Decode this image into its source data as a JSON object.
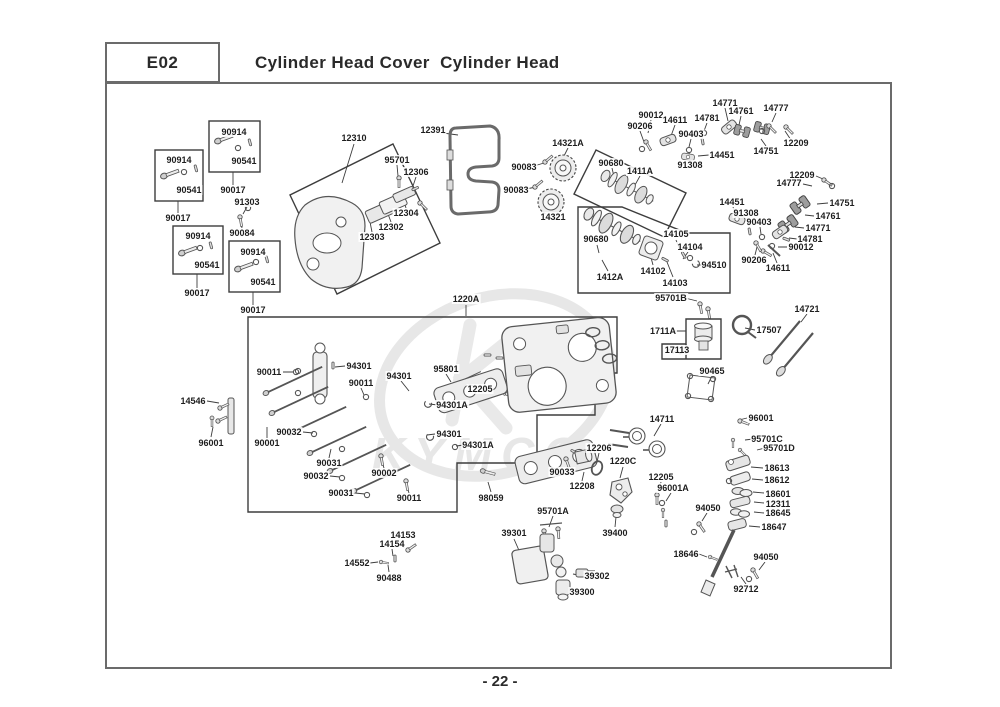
{
  "header": {
    "code": "E02",
    "title": "Cylinder Head Cover  Cylinder Head"
  },
  "footer": {
    "page_number": "- 22 -"
  },
  "watermark": {
    "text": "KYMCO"
  },
  "diagram": {
    "labels": [
      {
        "text": "90914",
        "x": 234,
        "y": 132
      },
      {
        "text": "90541",
        "x": 244,
        "y": 161
      },
      {
        "text": "90017",
        "x": 233,
        "y": 190
      },
      {
        "text": "90914",
        "x": 179,
        "y": 160
      },
      {
        "text": "90541",
        "x": 189,
        "y": 190
      },
      {
        "text": "90017",
        "x": 178,
        "y": 218
      },
      {
        "text": "91303",
        "x": 247,
        "y": 202
      },
      {
        "text": "90084",
        "x": 242,
        "y": 233
      },
      {
        "text": "90914",
        "x": 198,
        "y": 236
      },
      {
        "text": "90541",
        "x": 207,
        "y": 265
      },
      {
        "text": "90017",
        "x": 197,
        "y": 293
      },
      {
        "text": "90914",
        "x": 253,
        "y": 252
      },
      {
        "text": "90541",
        "x": 263,
        "y": 282
      },
      {
        "text": "90017",
        "x": 253,
        "y": 310
      },
      {
        "text": "12310",
        "x": 354,
        "y": 138
      },
      {
        "text": "95701",
        "x": 397,
        "y": 160
      },
      {
        "text": "12306",
        "x": 416,
        "y": 172
      },
      {
        "text": "12304",
        "x": 406,
        "y": 213
      },
      {
        "text": "12302",
        "x": 391,
        "y": 227
      },
      {
        "text": "12303",
        "x": 372,
        "y": 237
      },
      {
        "text": "12391",
        "x": 433,
        "y": 130
      },
      {
        "text": "14321A",
        "x": 568,
        "y": 143
      },
      {
        "text": "90083",
        "x": 524,
        "y": 167
      },
      {
        "text": "90083",
        "x": 516,
        "y": 190
      },
      {
        "text": "14321",
        "x": 553,
        "y": 217
      },
      {
        "text": "90012",
        "x": 651,
        "y": 115
      },
      {
        "text": "90206",
        "x": 640,
        "y": 126
      },
      {
        "text": "14611",
        "x": 675,
        "y": 120
      },
      {
        "text": "14781",
        "x": 707,
        "y": 118
      },
      {
        "text": "14771",
        "x": 725,
        "y": 103
      },
      {
        "text": "14761",
        "x": 741,
        "y": 111
      },
      {
        "text": "14777",
        "x": 776,
        "y": 108
      },
      {
        "text": "12209",
        "x": 796,
        "y": 143
      },
      {
        "text": "14751",
        "x": 766,
        "y": 151
      },
      {
        "text": "90403",
        "x": 691,
        "y": 134
      },
      {
        "text": "14451",
        "x": 722,
        "y": 155
      },
      {
        "text": "91308",
        "x": 690,
        "y": 165
      },
      {
        "text": "90680",
        "x": 611,
        "y": 163
      },
      {
        "text": "1411A",
        "x": 640,
        "y": 171
      },
      {
        "text": "12209",
        "x": 802,
        "y": 175
      },
      {
        "text": "14777",
        "x": 789,
        "y": 183
      },
      {
        "text": "14751",
        "x": 842,
        "y": 203
      },
      {
        "text": "14761",
        "x": 828,
        "y": 216
      },
      {
        "text": "14771",
        "x": 818,
        "y": 228
      },
      {
        "text": "14781",
        "x": 810,
        "y": 239
      },
      {
        "text": "90012",
        "x": 801,
        "y": 247
      },
      {
        "text": "14451",
        "x": 732,
        "y": 202
      },
      {
        "text": "91308",
        "x": 746,
        "y": 213
      },
      {
        "text": "90403",
        "x": 759,
        "y": 222
      },
      {
        "text": "90206",
        "x": 754,
        "y": 260
      },
      {
        "text": "14611",
        "x": 778,
        "y": 268
      },
      {
        "text": "90680",
        "x": 596,
        "y": 239
      },
      {
        "text": "1412A",
        "x": 610,
        "y": 277
      },
      {
        "text": "14102",
        "x": 653,
        "y": 271
      },
      {
        "text": "14103",
        "x": 675,
        "y": 283
      },
      {
        "text": "14104",
        "x": 690,
        "y": 247
      },
      {
        "text": "14105",
        "x": 676,
        "y": 234
      },
      {
        "text": "94510",
        "x": 714,
        "y": 265
      },
      {
        "text": "1220A",
        "x": 466,
        "y": 299
      },
      {
        "text": "90011",
        "x": 269,
        "y": 372
      },
      {
        "text": "94301",
        "x": 359,
        "y": 366
      },
      {
        "text": "90011",
        "x": 361,
        "y": 383
      },
      {
        "text": "95801",
        "x": 446,
        "y": 369
      },
      {
        "text": "94301",
        "x": 399,
        "y": 376
      },
      {
        "text": "12205",
        "x": 480,
        "y": 389
      },
      {
        "text": "94301A",
        "x": 452,
        "y": 405
      },
      {
        "text": "90032",
        "x": 289,
        "y": 432
      },
      {
        "text": "90001",
        "x": 267,
        "y": 443
      },
      {
        "text": "94301",
        "x": 449,
        "y": 434
      },
      {
        "text": "94301A",
        "x": 478,
        "y": 445
      },
      {
        "text": "90031",
        "x": 329,
        "y": 463
      },
      {
        "text": "90032",
        "x": 316,
        "y": 476
      },
      {
        "text": "90002",
        "x": 384,
        "y": 473
      },
      {
        "text": "90031",
        "x": 341,
        "y": 493
      },
      {
        "text": "90011",
        "x": 409,
        "y": 498
      },
      {
        "text": "98059",
        "x": 491,
        "y": 498
      },
      {
        "text": "14546",
        "x": 193,
        "y": 401
      },
      {
        "text": "96001",
        "x": 211,
        "y": 443
      },
      {
        "text": "95701B",
        "x": 671,
        "y": 298
      },
      {
        "text": "1711A",
        "x": 663,
        "y": 331
      },
      {
        "text": "17113",
        "x": 677,
        "y": 350
      },
      {
        "text": "17507",
        "x": 769,
        "y": 330
      },
      {
        "text": "14721",
        "x": 807,
        "y": 309
      },
      {
        "text": "90465",
        "x": 712,
        "y": 371
      },
      {
        "text": "96001",
        "x": 761,
        "y": 418
      },
      {
        "text": "14711",
        "x": 662,
        "y": 419
      },
      {
        "text": "95701C",
        "x": 767,
        "y": 439
      },
      {
        "text": "95701D",
        "x": 779,
        "y": 448
      },
      {
        "text": "18613",
        "x": 777,
        "y": 468
      },
      {
        "text": "18612",
        "x": 777,
        "y": 480
      },
      {
        "text": "18601",
        "x": 778,
        "y": 494
      },
      {
        "text": "12311",
        "x": 778,
        "y": 504
      },
      {
        "text": "18645",
        "x": 778,
        "y": 513
      },
      {
        "text": "18647",
        "x": 774,
        "y": 527
      },
      {
        "text": "94050",
        "x": 766,
        "y": 557
      },
      {
        "text": "92712",
        "x": 746,
        "y": 589
      },
      {
        "text": "12206",
        "x": 599,
        "y": 448
      },
      {
        "text": "1220C",
        "x": 623,
        "y": 461
      },
      {
        "text": "12205",
        "x": 661,
        "y": 477
      },
      {
        "text": "96001A",
        "x": 673,
        "y": 488
      },
      {
        "text": "12208",
        "x": 582,
        "y": 486
      },
      {
        "text": "39400",
        "x": 615,
        "y": 533
      },
      {
        "text": "94050",
        "x": 708,
        "y": 508
      },
      {
        "text": "18646",
        "x": 686,
        "y": 554
      },
      {
        "text": "90033",
        "x": 562,
        "y": 472
      },
      {
        "text": "95701A",
        "x": 553,
        "y": 511
      },
      {
        "text": "39301",
        "x": 514,
        "y": 533
      },
      {
        "text": "39302",
        "x": 597,
        "y": 576
      },
      {
        "text": "39300",
        "x": 582,
        "y": 592
      },
      {
        "text": "14153",
        "x": 403,
        "y": 535
      },
      {
        "text": "14154",
        "x": 392,
        "y": 544
      },
      {
        "text": "14552",
        "x": 357,
        "y": 563
      },
      {
        "text": "90488",
        "x": 389,
        "y": 578
      }
    ]
  }
}
